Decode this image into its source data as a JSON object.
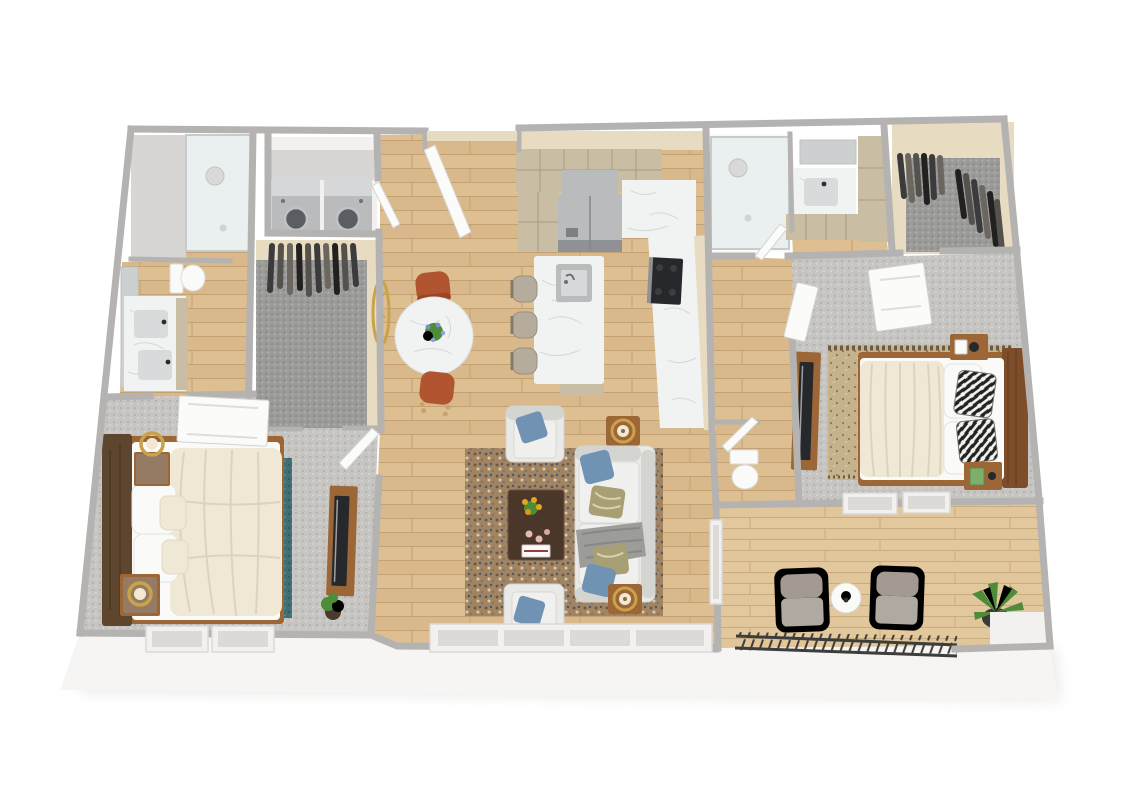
{
  "title": "3D dollhouse floor plan rendering of a two-bedroom, two-bath apartment with patio",
  "view": "top-down 3D render, no visible text or UI controls",
  "colors": {
    "wall_top": "#b5b3b1",
    "wall_face": "#f2f1f0",
    "wall_shadow": "#d8d6d4",
    "exterior_skirt": "#f6f5f4",
    "floor_wood": "#d9b98b",
    "floor_wood_dark": "#c4a172",
    "floor_wood_light": "#e5cb9f",
    "patio_deck": "#e0c69a",
    "patio_deck_line": "#c9ac7e",
    "carpet": "#c7c5c2",
    "carpet_dot": "#a8a6a3",
    "closet_carpet": "#9b9b99",
    "closet_carpet_dot": "#777775",
    "tan_wall": "#e7dcc1",
    "cabinet_tan": "#c9bda3",
    "cabinet_tan_dark": "#a89c82",
    "marble": "#f1f2f2",
    "marble_vein": "#d5d7d8",
    "stainless": "#b9bbbd",
    "stainless_dark": "#8f9194",
    "appliance_black": "#26282b",
    "glass": "#dde6e8",
    "teal_rug": "#3f6f72",
    "teal_rug_dot": "#2e565a",
    "living_rug": "#a08463",
    "bedroom2_rug": "#c6b28c",
    "bedroom2_rug_dot": "#8a7a5c",
    "sofa": "#e9e9e7",
    "sofa_shadow": "#d4d4d1",
    "pillow_blue": "#7093b4",
    "pillow_olive": "#a89f74",
    "throw_gray": "#9c9c98",
    "wood_medium": "#9c6637",
    "wood_dark": "#5d452e",
    "coffee_table": "#4a372a",
    "terracotta": "#b05530",
    "cream_bedding": "#efe8d5",
    "white_linen": "#fafaf8",
    "gold": "#c9a24a",
    "plant_green": "#4d8c38",
    "patio_chair": "#a29a92",
    "railing_dark": "#3d3d3b",
    "stone_top": "#8f8d8a",
    "zebra_black": "#222222"
  },
  "scene": {
    "type": "3d-floorplan-render",
    "rooms": [
      {
        "name": "Bathroom 1",
        "floor": "wood",
        "furniture": [
          "glass walk-in shower",
          "toilet",
          "marble-top vanity with sinks",
          "mirror"
        ]
      },
      {
        "name": "Laundry Closet",
        "floor": "light",
        "furniture": [
          "washer",
          "dryer"
        ]
      },
      {
        "name": "Walk-in Closet 1",
        "floor": "gray carpet",
        "furniture": [
          "hanging clothes rack"
        ]
      },
      {
        "name": "Entry",
        "floor": "wood",
        "furniture": [
          "open front door"
        ]
      },
      {
        "name": "Kitchen",
        "floor": "wood",
        "furniture": [
          "tan upper cabinets",
          "pantry cabinet",
          "stainless refrigerator",
          "black range",
          "marble L-shaped counter",
          "marble island with sink",
          "three bar stools"
        ]
      },
      {
        "name": "Dining Area",
        "floor": "wood",
        "furniture": [
          "round white marble table",
          "two terracotta chairs",
          "blue flower centerpiece",
          "round gold wall mirror"
        ]
      },
      {
        "name": "Living Room",
        "floor": "wood",
        "furniture": [
          "white sofa with blue and olive pillows and gray throw",
          "two white armchairs with blue pillows",
          "dark wood coffee table with yellow flowers and candles",
          "two wood side tables with gold ring lamps",
          "multicolor speckled area rug",
          "window wall"
        ]
      },
      {
        "name": "Hallway",
        "floor": "wood",
        "furniture": [
          "white paneled doors"
        ]
      },
      {
        "name": "Bathroom 2",
        "floor": "wood",
        "furniture": [
          "glass shower",
          "marble vanity with sink",
          "mirror",
          "tan linen tower",
          "separate toilet room"
        ]
      },
      {
        "name": "Walk-in Closet 2",
        "floor": "dark gray carpet",
        "furniture": [
          "hanging clothes on two racks"
        ]
      },
      {
        "name": "Bedroom 1",
        "floor": "gray carpet",
        "furniture": [
          "bed with brown wood headboard, white pillows and cream duvet",
          "two wood nightstands with ring lamps",
          "teal area rug",
          "wood TV console with TV",
          "potted plant",
          "two windows"
        ]
      },
      {
        "name": "Bedroom 2",
        "floor": "gray carpet",
        "furniture": [
          "wood platform bed with cream duvet, white and zebra pillows",
          "floating wood nightstands with clock and books",
          "tan patterned rug with fringe",
          "wood TV stand with TV",
          "two windows"
        ]
      },
      {
        "name": "Patio",
        "floor": "light wood deck",
        "furniture": [
          "two gray lounge chairs",
          "round white side table with plant",
          "potted plant",
          "metal slat railing"
        ]
      }
    ]
  }
}
